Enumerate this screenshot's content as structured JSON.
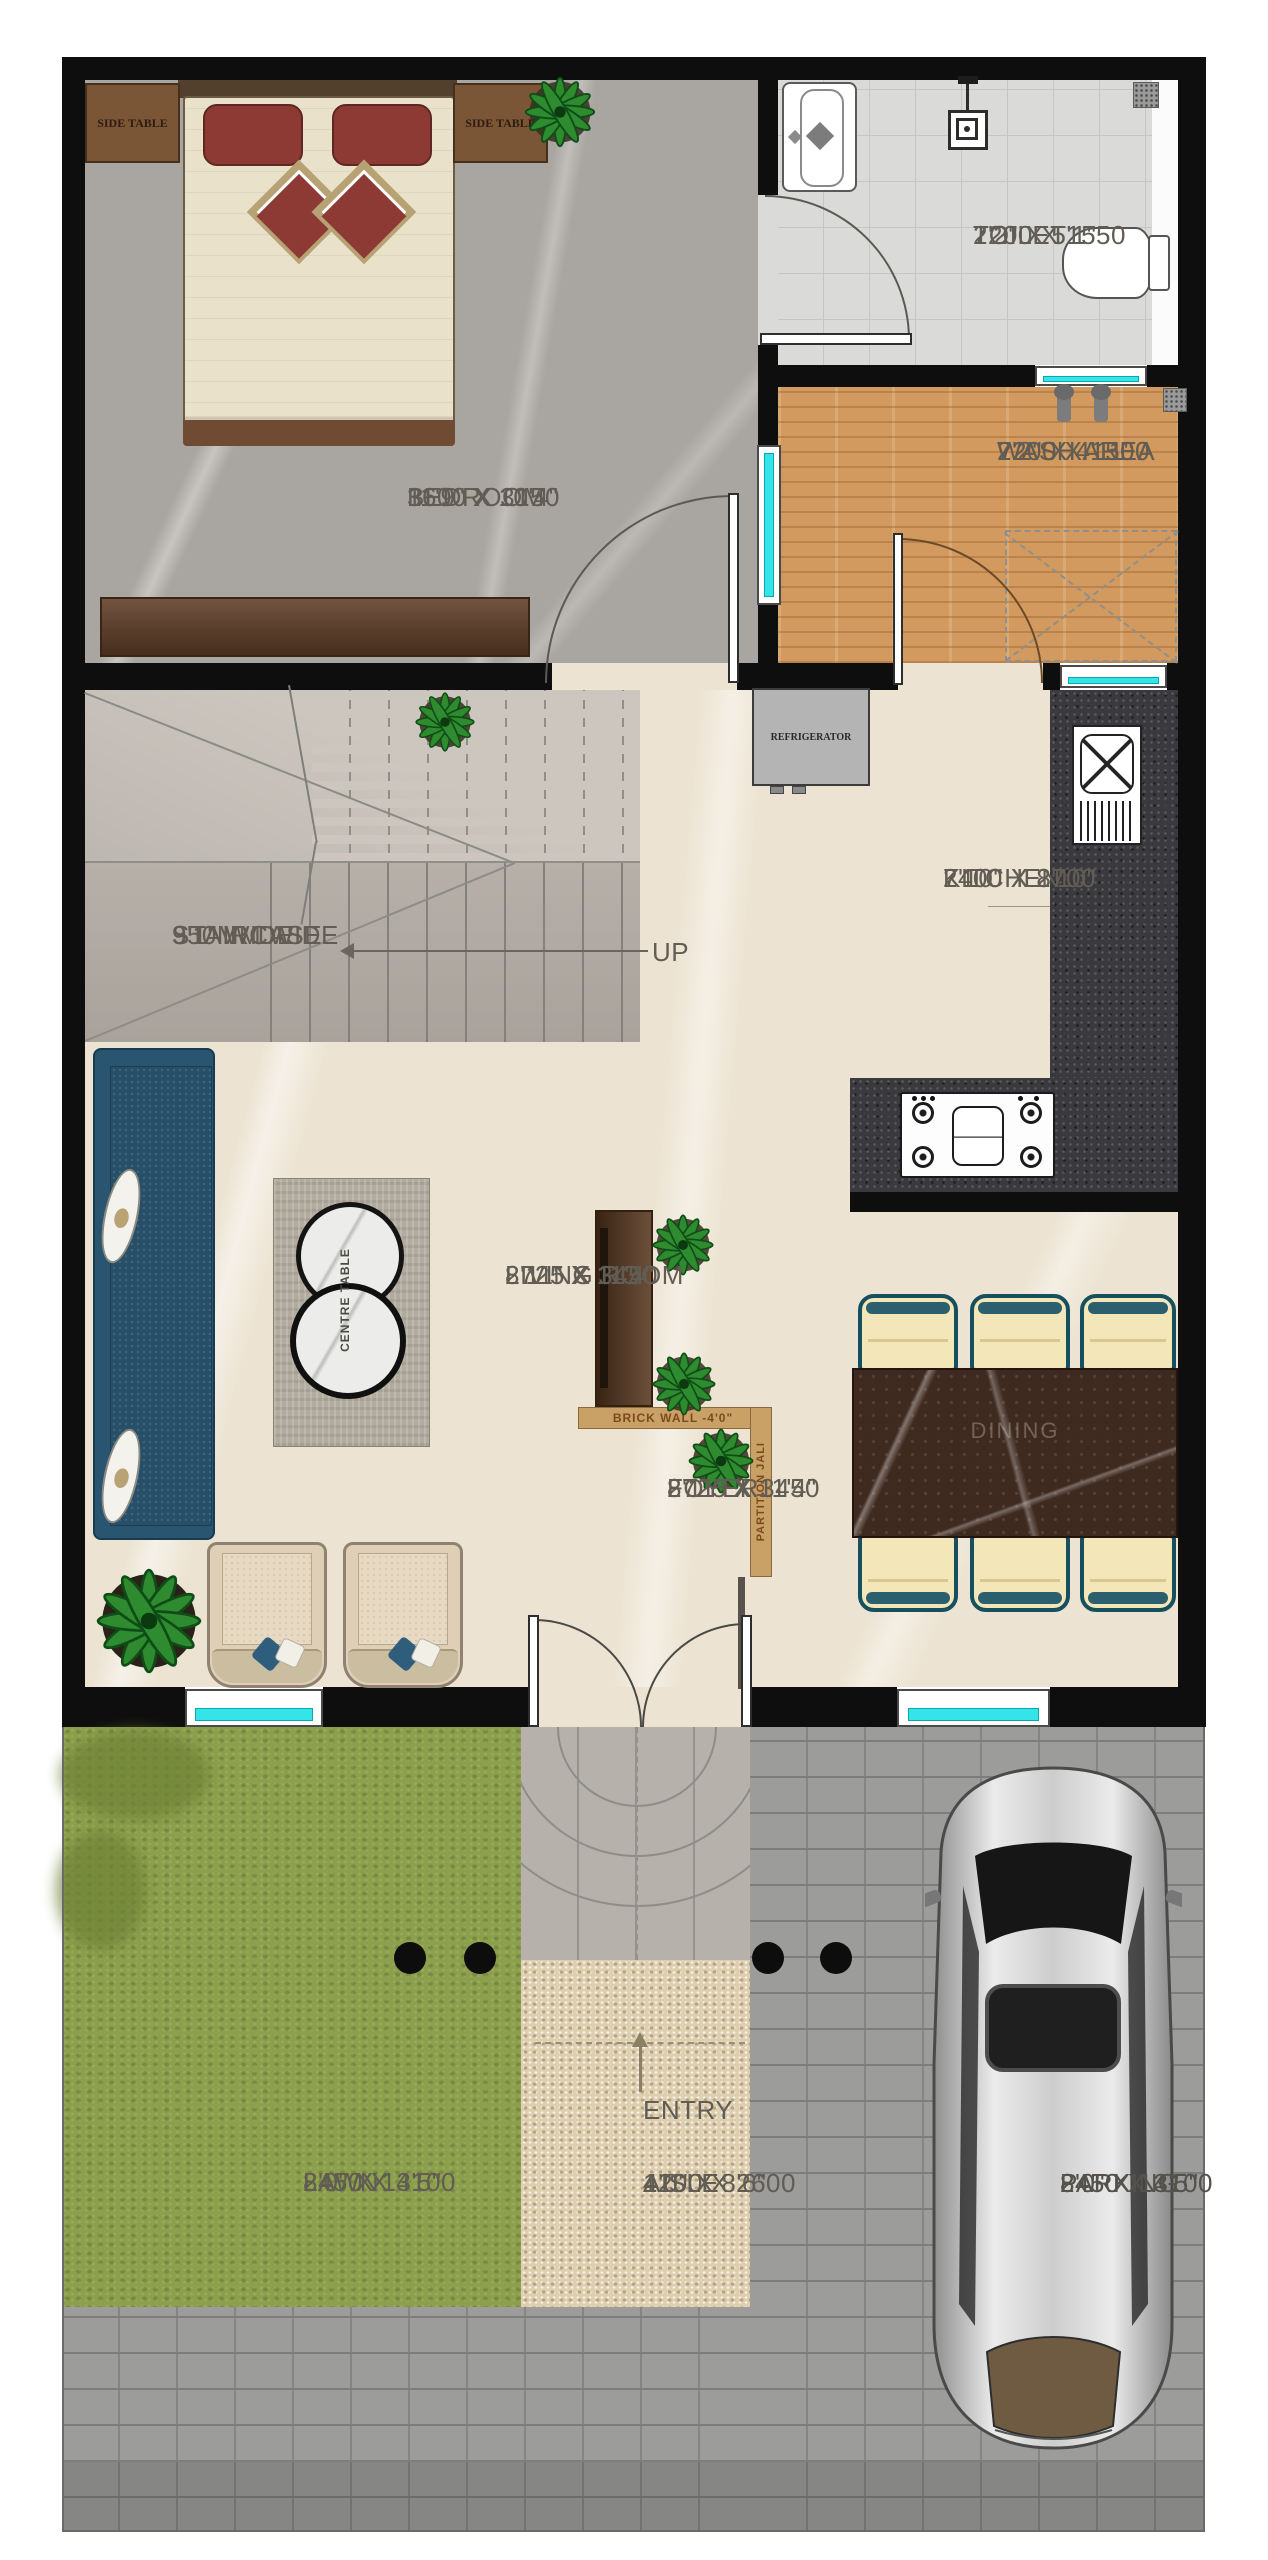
{
  "plan_type": "residential-floor-plan",
  "rooms": {
    "bedroom": {
      "name": "BEDROOM",
      "mm": "3600 X 3150",
      "ft": "11'9\" X 10'4\""
    },
    "toilet": {
      "name": "TOILET",
      "mm": "2200 X 1550",
      "ft": "7'2\" X 5'1\""
    },
    "wash": {
      "name": "WASH AREA",
      "mm": "2200 X 1500",
      "ft": "7'2\" X 4'11\""
    },
    "kitchen": {
      "name": "KITCHEN",
      "mm": "2400 X 2700",
      "ft": "7'10\" X 8'10\""
    },
    "staircase": {
      "name": "STAIRCASE",
      "mm": "950MM WIDE",
      "ft": "3'1\" WIDE"
    },
    "living": {
      "name": "LIVING ROOM",
      "mm": "2725 X 3450",
      "ft": "8'11\" X 11'4\""
    },
    "foyer": {
      "name": "FOYER",
      "mm": "2725 X 3450",
      "ft": "8'11\" X 11'4\""
    },
    "dining": {
      "name": "DINING"
    },
    "lawn": {
      "name": "LAWN",
      "mm": "2450 X 4100",
      "ft": "8'0\" X 13'5\""
    },
    "aisle": {
      "name": "AISLE",
      "mm": "1200 X 2600",
      "ft": "4'0\" X 8'6\""
    },
    "parking": {
      "name": "PARKING",
      "mm": "2450 X 4100",
      "ft": "8'0\" X 13'5\""
    }
  },
  "labels": {
    "up": "UP",
    "entry": "ENTRY",
    "side_table": "SIDE TABLE",
    "refrigerator": "REFRIGERATOR",
    "centre_table": "CENTRE TABLE",
    "brick_wall": "BRICK WALL -4'0\"",
    "partition": "PARTITION JALI"
  },
  "colors": {
    "wall": "#0e0e0e",
    "window_glass": "#35e4e9",
    "floor_cream": "#ece3d2",
    "floor_marble_gray": "#a9a5a0",
    "floor_wood": "#d29a5e",
    "counter_granite": "#3a3a3e",
    "dining_marble": "#3f2a20",
    "chair_cream": "#f3e6b9",
    "chair_teal": "#16505f",
    "sofa_blue": "#2a5570",
    "lawn_green": "#8ca04c",
    "gravel": "#decfb0",
    "paver_gray": "#9c9c9a",
    "accent_tan": "#c9a066",
    "car_silver": "#cfcfcf"
  }
}
